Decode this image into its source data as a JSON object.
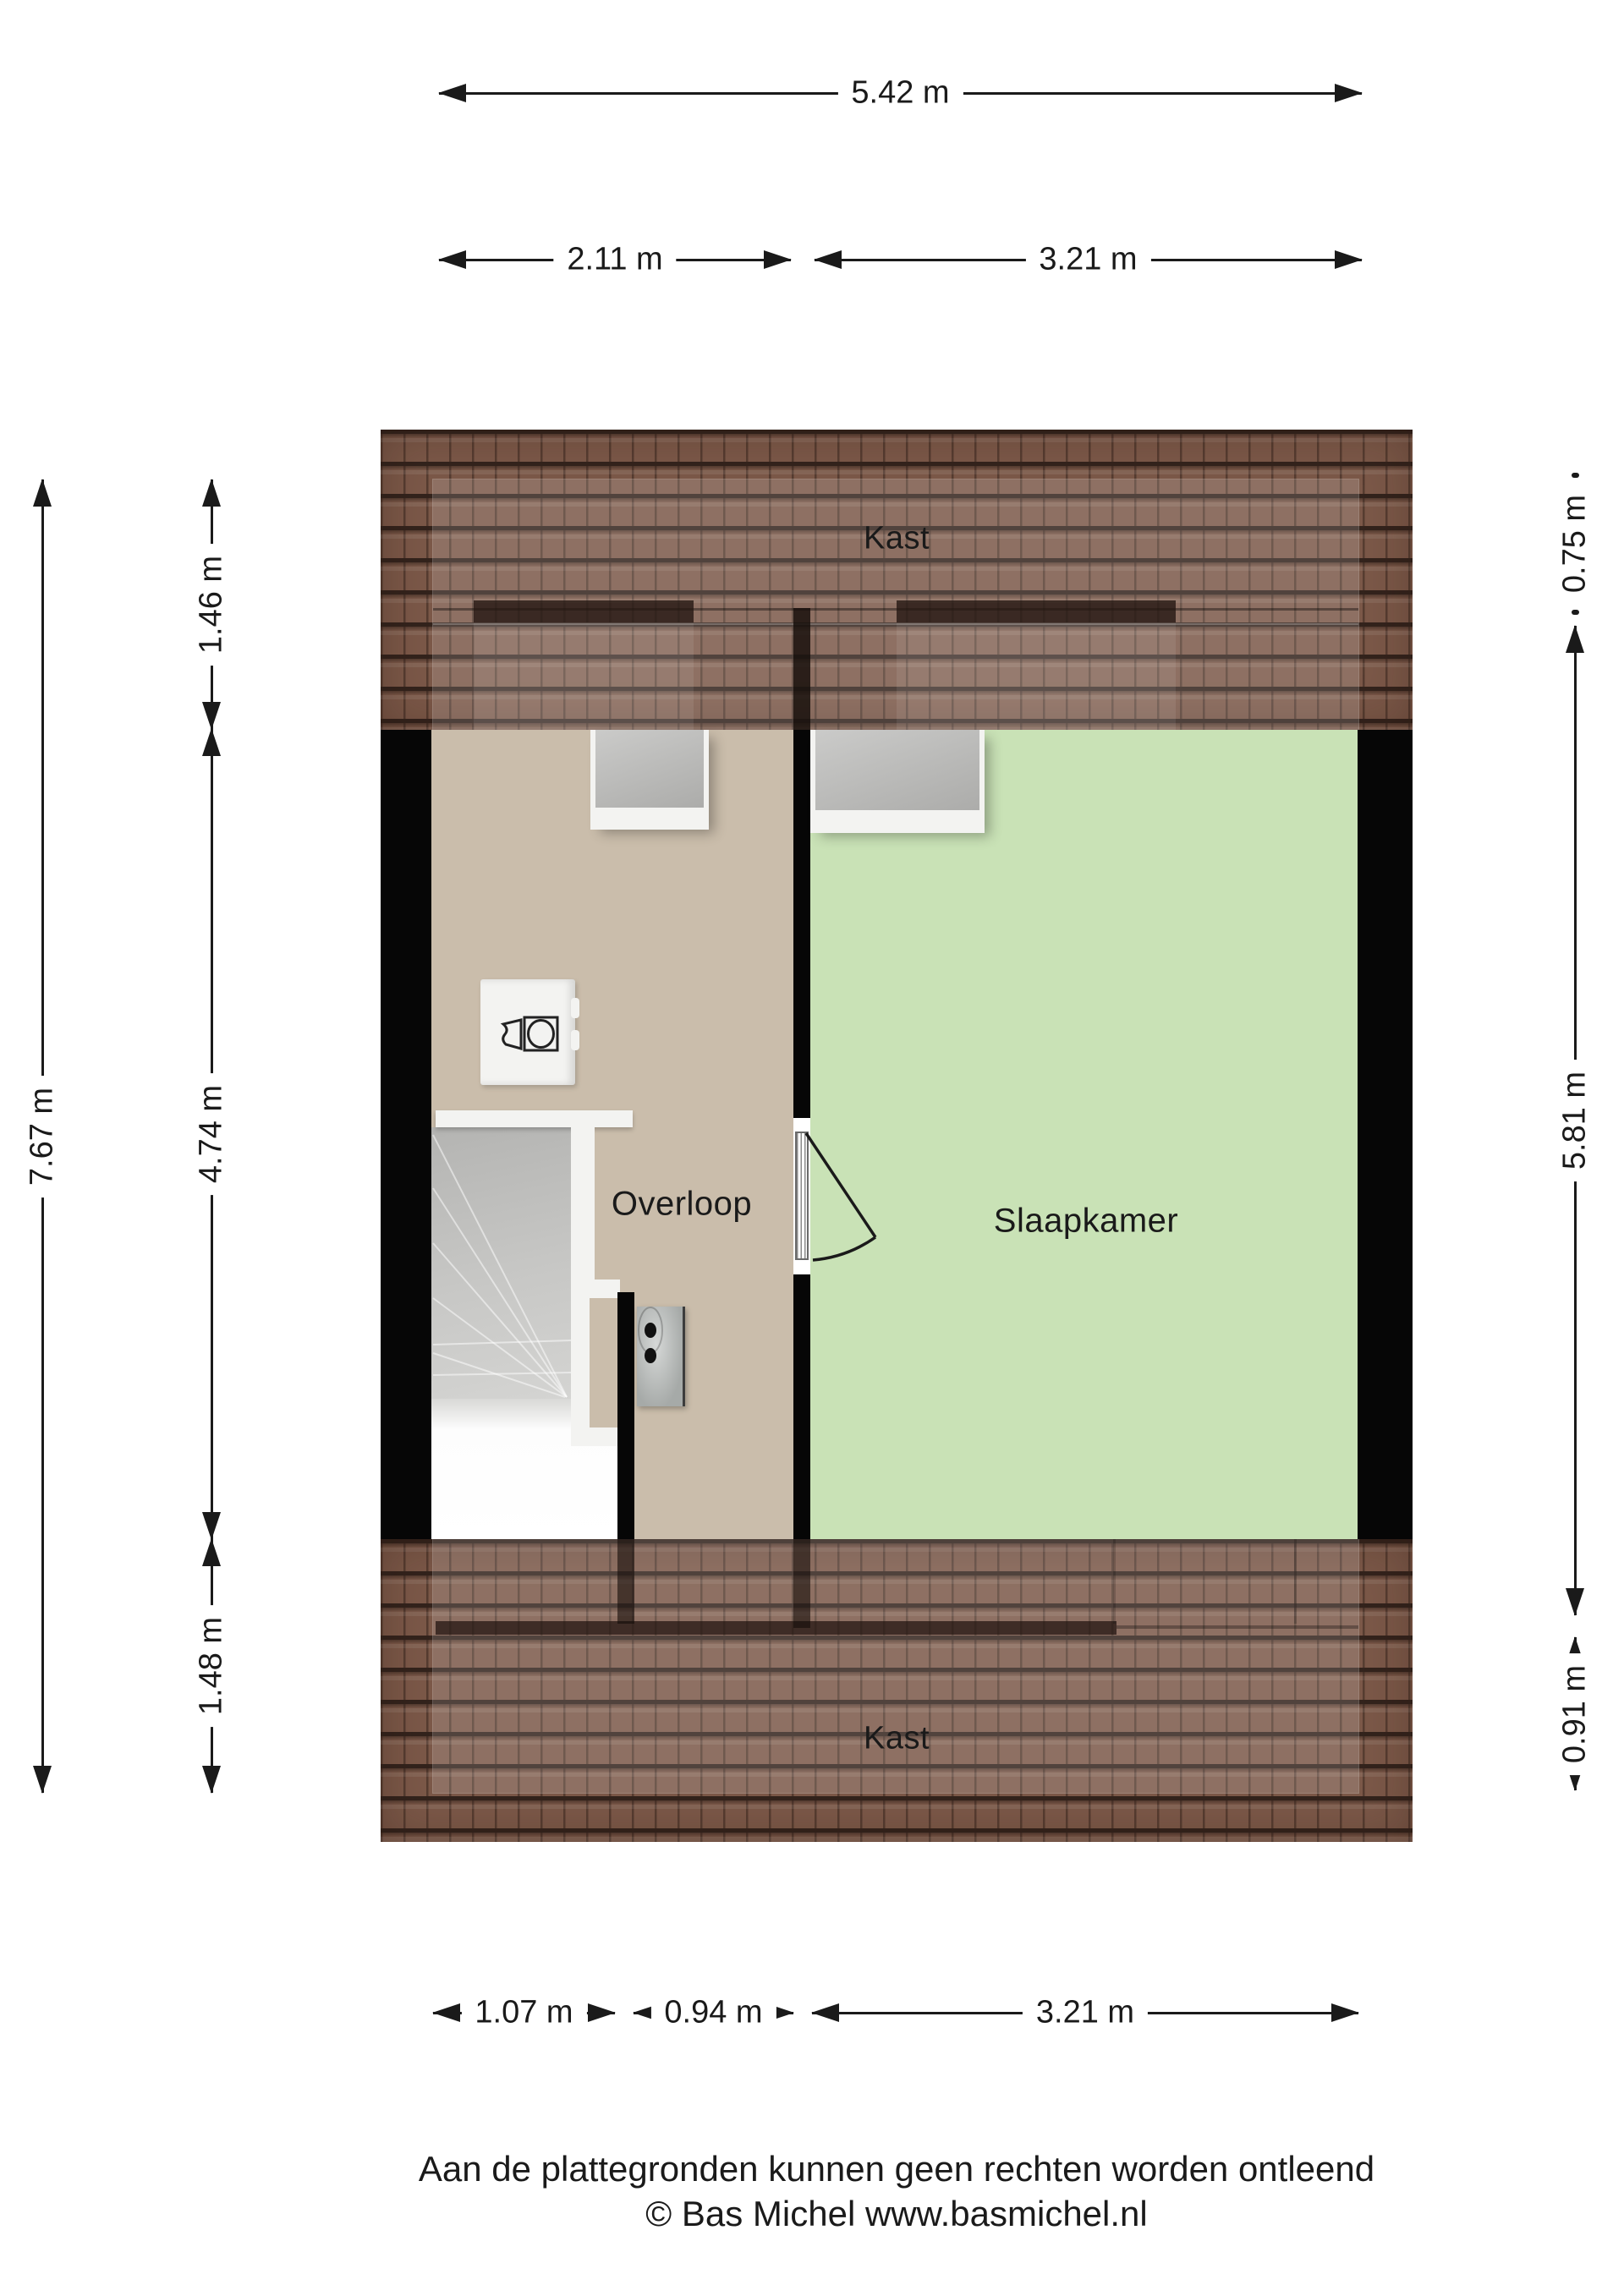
{
  "rooms": {
    "kast_top": "Kast",
    "overloop": "Overloop",
    "slaapkamer": "Slaapkamer",
    "kast_bottom": "Kast"
  },
  "dimensions": {
    "top_total": "5.42 m",
    "top_overloop": "2.11 m",
    "top_slaapkamer": "3.21 m",
    "left_total": "7.67 m",
    "left_top": "1.46 m",
    "left_middle": "4.74 m",
    "left_bottom": "1.48 m",
    "right_top": "0.75 m",
    "right_middle": "5.81 m",
    "right_bottom": "0.91 m",
    "bottom_stairwell": "1.07 m",
    "bottom_overloop": "0.94 m",
    "bottom_slaapkamer": "3.21 m"
  },
  "footer": {
    "line1": "Aan de plattegronden kunnen geen rechten worden ontleend",
    "line2": "© Bas Michel www.basmichel.nl"
  },
  "icons": {
    "washing_machine": "washing-machine-icon",
    "electrical_panel": "electrical-panel-icon",
    "door_swing": "door-swing-arc",
    "stairs": "winder-stairs"
  },
  "colors": {
    "roof-base": "#7b5848",
    "roof-line": "#33231c",
    "floor-overloop": "#cabdab",
    "floor-slaapkamer": "#c9e2b6",
    "wall": "#060606",
    "window-pane": "#b9b9b7",
    "frame-white": "#f3f3f1",
    "stairs-gray": "#c6c6c4",
    "ink": "#1a1a1a"
  }
}
